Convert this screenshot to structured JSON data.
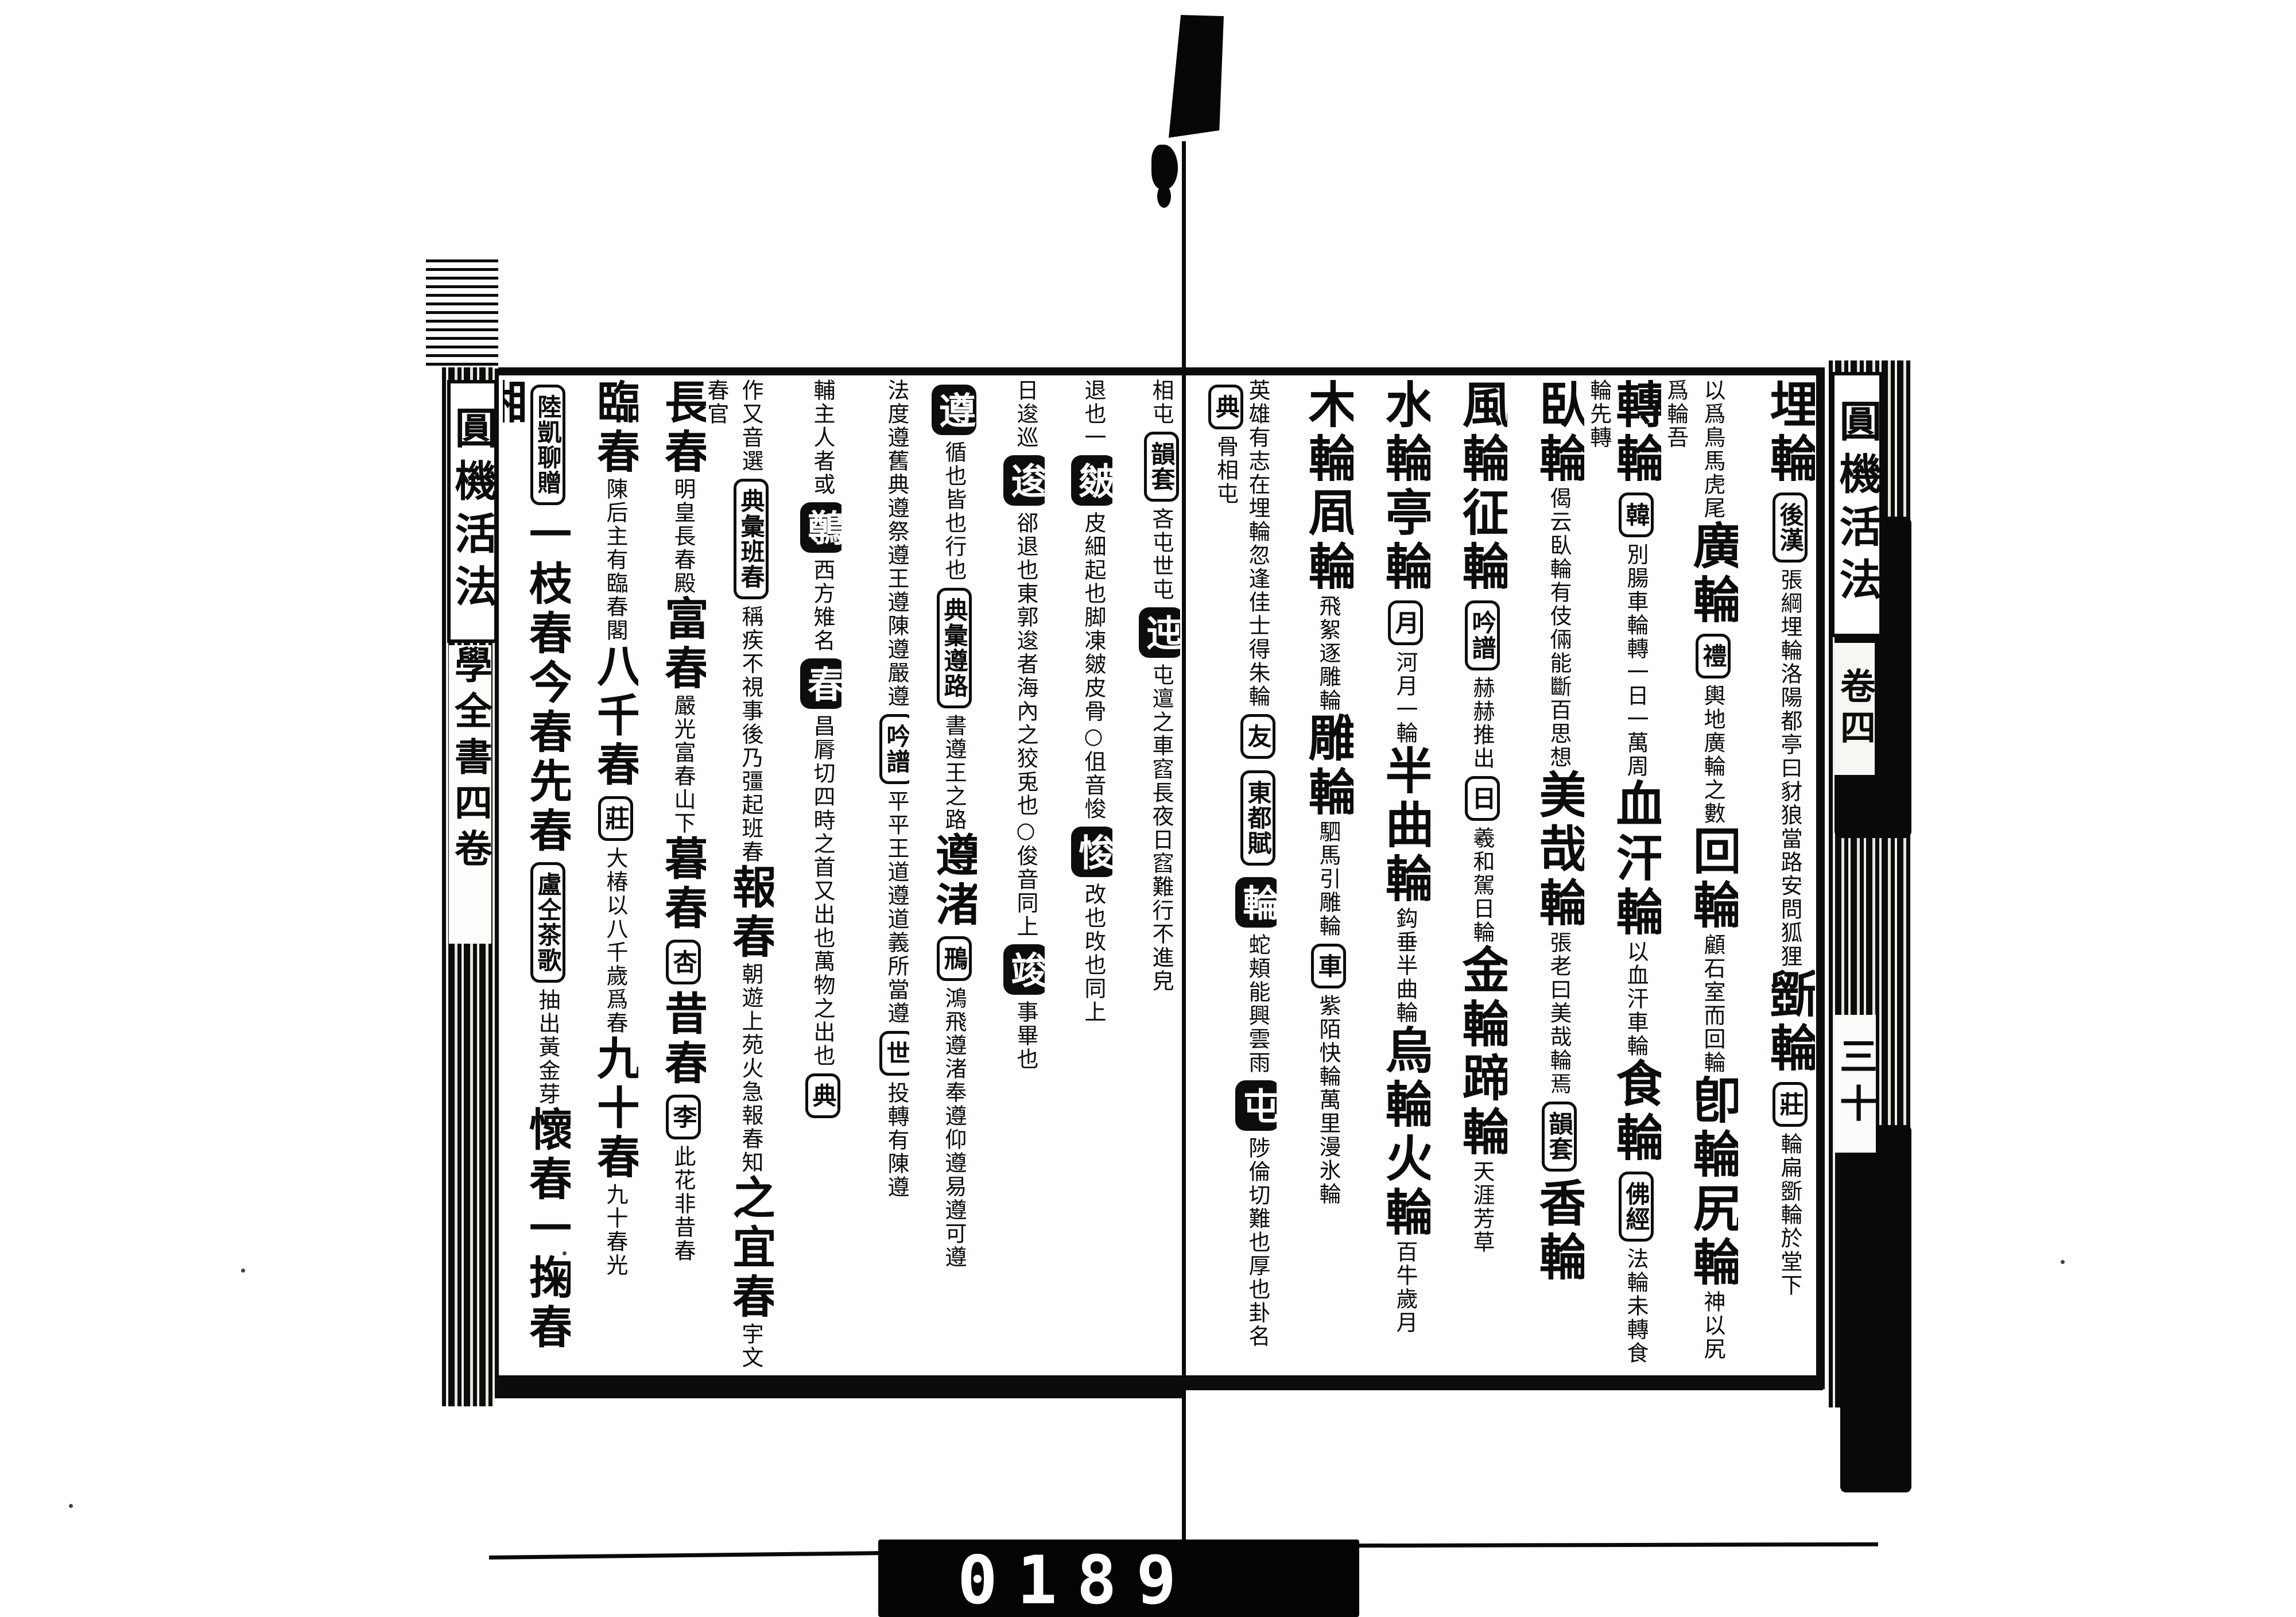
{
  "colors": {
    "ink": "#0d0c0a",
    "paper": "#ffffff",
    "counter_bg": "#040404",
    "counter_digits": "#ffffff"
  },
  "film": {
    "counter_digits": "0189",
    "marker": "film-frame-marker"
  },
  "spine_left": {
    "title": "圓機活法",
    "subtitle": "學全書四卷"
  },
  "spine_right": {
    "title": "圓機活法",
    "volume": "卷四",
    "folio": "三十"
  },
  "right_page": {
    "columns": [
      {
        "segments": [
          {
            "t": "head",
            "v": "埋輪"
          },
          {
            "t": "tag",
            "v": "後漢"
          },
          {
            "t": "note",
            "v": "張綱埋輪洛陽都亭曰豺狼當路安問狐狸"
          },
          {
            "t": "head",
            "v": "斵輪"
          },
          {
            "t": "tag",
            "v": "莊"
          },
          {
            "t": "note",
            "v": "輪扁斵輪於堂下"
          }
        ]
      },
      {
        "segments": [
          {
            "t": "note",
            "v": "以爲鳥馬虎尾"
          },
          {
            "t": "head",
            "v": "廣輪"
          },
          {
            "t": "tag",
            "v": "禮"
          },
          {
            "t": "note",
            "v": "輿地廣輪之數"
          },
          {
            "t": "head",
            "v": "回輪"
          },
          {
            "t": "note",
            "v": "顧石室而回輪"
          },
          {
            "t": "head",
            "v": "卽輪"
          },
          {
            "t": "head",
            "v": "尻輪"
          },
          {
            "t": "note",
            "v": "神以尻爲輪吾"
          }
        ]
      },
      {
        "segments": [
          {
            "t": "head",
            "v": "轉輪"
          },
          {
            "t": "tag",
            "v": "韓"
          },
          {
            "t": "note",
            "v": "別腸車輪轉一日一萬周"
          },
          {
            "t": "head",
            "v": "血汗輪"
          },
          {
            "t": "note",
            "v": "以血汗車輪"
          },
          {
            "t": "head",
            "v": "食輪"
          },
          {
            "t": "tag",
            "v": "佛經"
          },
          {
            "t": "note",
            "v": "法輪未轉食輪先轉"
          }
        ]
      },
      {
        "segments": [
          {
            "t": "head",
            "v": "臥輪"
          },
          {
            "t": "note",
            "v": "偈云臥輪有伎倆能斷百思想"
          },
          {
            "t": "head",
            "v": "美哉輪"
          },
          {
            "t": "note",
            "v": "張老曰美哉輪焉"
          },
          {
            "t": "tag",
            "v": "韻套"
          },
          {
            "t": "head",
            "v": "香輪"
          }
        ]
      },
      {
        "segments": [
          {
            "t": "head",
            "v": "風輪"
          },
          {
            "t": "head",
            "v": "征輪"
          },
          {
            "t": "tag",
            "v": "吟譜"
          },
          {
            "t": "note",
            "v": "赫赫推出"
          },
          {
            "t": "tag",
            "v": "日"
          },
          {
            "t": "note",
            "v": "羲和駕日輪"
          },
          {
            "t": "head",
            "v": "金輪"
          },
          {
            "t": "head",
            "v": "蹄輪"
          },
          {
            "t": "note",
            "v": "天涯芳草"
          }
        ]
      },
      {
        "segments": [
          {
            "t": "head",
            "v": "水輪"
          },
          {
            "t": "head",
            "v": "亭輪"
          },
          {
            "t": "tag",
            "v": "月"
          },
          {
            "t": "note",
            "v": "河月一輪"
          },
          {
            "t": "head",
            "v": "半曲輪"
          },
          {
            "t": "note",
            "v": "鈎垂半曲輪"
          },
          {
            "t": "head",
            "v": "烏輪"
          },
          {
            "t": "head",
            "v": "火輪"
          },
          {
            "t": "note",
            "v": "百牛歲月"
          }
        ]
      },
      {
        "segments": [
          {
            "t": "head",
            "v": "木輪"
          },
          {
            "t": "head",
            "v": "凮輪"
          },
          {
            "t": "note",
            "v": "飛絮逐雕輪"
          },
          {
            "t": "head",
            "v": "雕輪"
          },
          {
            "t": "note",
            "v": "駟馬引雕輪"
          },
          {
            "t": "tag",
            "v": "車"
          },
          {
            "t": "note",
            "v": "紫陌快輪萬里漫氷輪"
          }
        ]
      },
      {
        "segments": [
          {
            "t": "note",
            "v": "英雄有志在埋輪"
          },
          {
            "t": "note",
            "v": "忽逢佳士得朱輪"
          },
          {
            "t": "tag",
            "v": "友"
          },
          {
            "t": "tag",
            "v": "東都賦"
          },
          {
            "t": "itag",
            "v": "輪"
          },
          {
            "t": "note",
            "v": "蛇頬能興雲雨"
          },
          {
            "t": "itag",
            "v": "屯"
          },
          {
            "t": "note",
            "v": "陟倫切難也厚也卦名"
          },
          {
            "t": "tag",
            "v": "典"
          },
          {
            "t": "note",
            "v": "骨相屯"
          }
        ]
      }
    ]
  },
  "left_page": {
    "columns": [
      {
        "segments": [
          {
            "t": "note",
            "v": "相屯"
          },
          {
            "t": "tag",
            "v": "韻套"
          },
          {
            "t": "note",
            "v": "吝屯世屯"
          },
          {
            "t": "itag",
            "v": "迍"
          },
          {
            "t": "note",
            "v": "屯邅之車"
          },
          {
            "t": "note",
            "v": "窞長夜日窞"
          },
          {
            "t": "note",
            "v": "難行不進皃"
          }
        ]
      },
      {
        "segments": [
          {
            "t": "note",
            "v": "退也一"
          },
          {
            "t": "itag",
            "v": "皴"
          },
          {
            "t": "note",
            "v": "皮細起也"
          },
          {
            "t": "note",
            "v": "脚凍皴皮骨"
          },
          {
            "t": "note",
            "v": "○伹音悛"
          },
          {
            "t": "itag",
            "v": "悛"
          },
          {
            "t": "note",
            "v": "改也攺也同上"
          }
        ]
      },
      {
        "segments": [
          {
            "t": "note",
            "v": "日逡巡"
          },
          {
            "t": "itag",
            "v": "逡"
          },
          {
            "t": "note",
            "v": "郤退也"
          },
          {
            "t": "note",
            "v": "東郭逡者海內之狡兎也"
          },
          {
            "t": "note",
            "v": "○俊音同上"
          },
          {
            "t": "itag",
            "v": "竣"
          },
          {
            "t": "note",
            "v": "事畢也"
          }
        ]
      },
      {
        "segments": [
          {
            "t": "itag",
            "v": "遵"
          },
          {
            "t": "note",
            "v": "循也皆也行也"
          },
          {
            "t": "tag",
            "v": "典彙遵路"
          },
          {
            "t": "note",
            "v": "書遵王之路"
          },
          {
            "t": "head",
            "v": "遵渚"
          },
          {
            "t": "tag",
            "v": "鳽"
          },
          {
            "t": "note",
            "v": "鴻飛遵渚"
          },
          {
            "t": "note",
            "v": "奉遵仰遵易遵可遵"
          }
        ]
      },
      {
        "segments": [
          {
            "t": "note",
            "v": "法度遵舊典遵"
          },
          {
            "t": "note",
            "v": "祭遵王遵陳遵嚴遵"
          },
          {
            "t": "tag",
            "v": "吟譜"
          },
          {
            "t": "note",
            "v": "平平王道遵道義所當遵"
          },
          {
            "t": "tag",
            "v": "世"
          },
          {
            "t": "note",
            "v": "投轉有陳遵"
          }
        ]
      },
      {
        "segments": [
          {
            "t": "note",
            "v": "輔主人者或"
          },
          {
            "t": "itag",
            "v": "鷷"
          },
          {
            "t": "note",
            "v": "西方雉名"
          },
          {
            "t": "itag",
            "v": "春"
          },
          {
            "t": "note",
            "v": "昌脣切四時之首又出也萬物之出也"
          },
          {
            "t": "tag",
            "v": "典"
          }
        ]
      },
      {
        "segments": [
          {
            "t": "note",
            "v": "作又音選"
          },
          {
            "t": "tag",
            "v": "典彙班春"
          },
          {
            "t": "note",
            "v": "稱疾不視事後乃彊起班春"
          },
          {
            "t": "head",
            "v": "報春"
          },
          {
            "t": "note",
            "v": "朝遊上苑火急報春知"
          },
          {
            "t": "head",
            "v": "之宜春"
          },
          {
            "t": "note",
            "v": "宇文春官"
          }
        ]
      },
      {
        "segments": [
          {
            "t": "head",
            "v": "長春"
          },
          {
            "t": "note",
            "v": "明皇長春殿"
          },
          {
            "t": "head",
            "v": "富春"
          },
          {
            "t": "note",
            "v": "嚴光富春山下"
          },
          {
            "t": "head",
            "v": "暮春"
          },
          {
            "t": "tag",
            "v": "杏"
          },
          {
            "t": "head",
            "v": "昔春"
          },
          {
            "t": "tag",
            "v": "李"
          },
          {
            "t": "note",
            "v": "此花非昔春"
          }
        ]
      },
      {
        "segments": [
          {
            "t": "head",
            "v": "臨春"
          },
          {
            "t": "note",
            "v": "陳后主有臨春閣"
          },
          {
            "t": "head",
            "v": "八千春"
          },
          {
            "t": "tag",
            "v": "莊"
          },
          {
            "t": "note",
            "v": "大椿以八千歲爲春"
          },
          {
            "t": "head",
            "v": "九十春"
          },
          {
            "t": "note",
            "v": "九十春光"
          }
        ]
      },
      {
        "segments": [
          {
            "t": "tag",
            "v": "陸凱聊贈"
          },
          {
            "t": "head",
            "v": "一枝春"
          },
          {
            "t": "head",
            "v": "今春"
          },
          {
            "t": "head",
            "v": "先春"
          },
          {
            "t": "tag",
            "v": "盧仝茶歌"
          },
          {
            "t": "note",
            "v": "抽出黃金芽"
          },
          {
            "t": "head",
            "v": "懷春"
          },
          {
            "t": "head",
            "v": "一掬春"
          },
          {
            "t": "head",
            "v": "湘"
          }
        ]
      }
    ]
  }
}
